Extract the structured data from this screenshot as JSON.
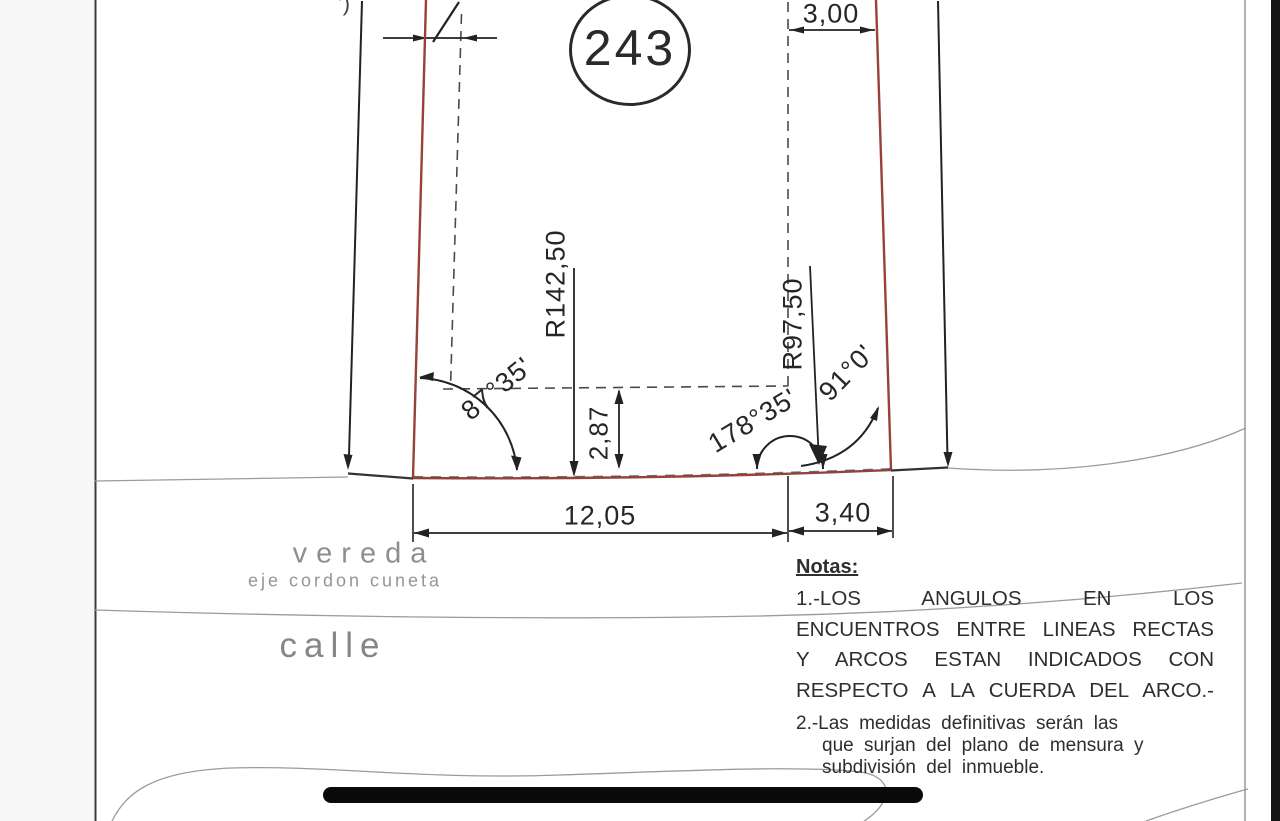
{
  "diagram": {
    "lot_number": "243",
    "top_fragment": "’)",
    "dimensions": {
      "front_offset": "3,00",
      "radius_left": "R142,50",
      "radius_right": "R97,50",
      "depth_offset": "2,87",
      "front_main": "12,05",
      "front_side": "3,40"
    },
    "angles": {
      "left": "87°35'",
      "center": "178°35'",
      "right": "91°0'"
    },
    "street_labels": {
      "sidewalk": "vereda",
      "curb_axis": "eje cordon cuneta",
      "street": "calle"
    },
    "notes": {
      "title": "Notas:",
      "note1_lines": [
        "1.-LOS ANGULOS EN LOS",
        "ENCUENTROS ENTRE LINEAS RECTAS",
        "Y ARCOS ESTAN INDICADOS CON",
        "RESPECTO A LA CUERDA DEL ARCO.-"
      ],
      "note2_lines": [
        "2.-Las medidas definitivas serán las",
        "que surjan del plano de mensura y",
        "subdivisión del inmueble."
      ]
    },
    "colors": {
      "boundary": "#96423b",
      "ink": "#222222",
      "faint": "#9b9b9b",
      "redaction": "#0a0a0a"
    }
  }
}
